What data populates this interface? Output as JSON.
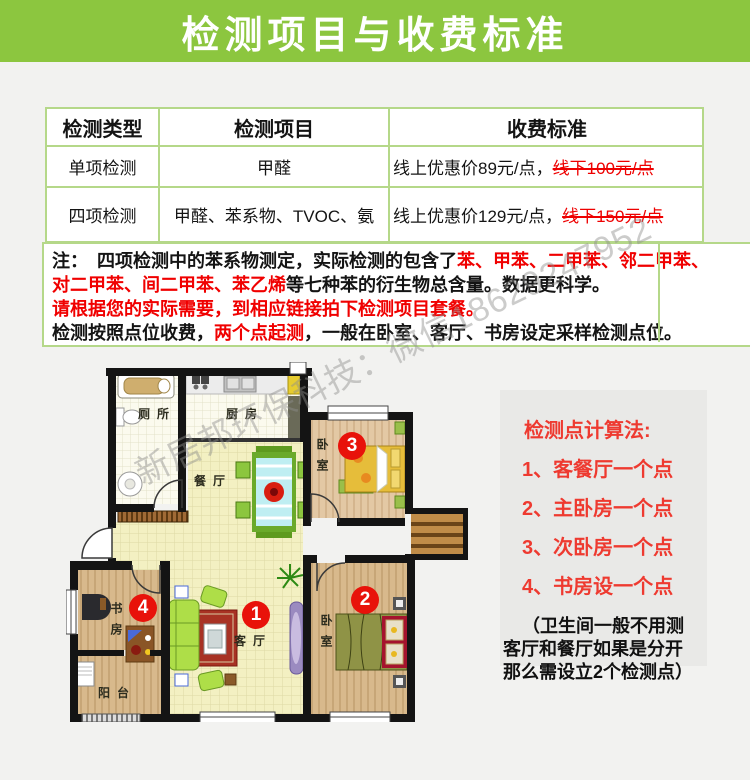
{
  "colors": {
    "header_green": "#8cc63f",
    "table_border_green": "#b5d889",
    "red_text": "#f00000",
    "panel_red": "#ee3a30",
    "marker_red": "#e8120a",
    "page_bg": "#f2f2f0",
    "panel_bg": "#e9e9e7"
  },
  "header": {
    "title": "检测项目与收费标准"
  },
  "table": {
    "headers": [
      "检测类型",
      "检测项目",
      "收费标准"
    ],
    "rows": [
      {
        "type": "单项检测",
        "items": "甲醛",
        "price_online": "线上优惠价89元/点，",
        "price_offline_struck": "线下100元/点"
      },
      {
        "type": "四项检测",
        "items": "甲醛、苯系物、TVOC、氨",
        "price_online": "线上优惠价129元/点，",
        "price_offline_struck": "线下150元/点"
      }
    ]
  },
  "note": {
    "l1a": "注：　四项检测中的苯系物测定，实际检测的包含了",
    "l1b": "苯、甲苯、二甲苯、邻二甲苯、",
    "l2a": "对二甲苯、间二甲苯、苯乙烯",
    "l2b": "等七种苯的衍生物总含量。数据更科学。",
    "l3": "请根据您的实际需要，到相应链接拍下检测项目套餐。",
    "l4a": "检测按照点位收费，",
    "l4b": "两个点起测",
    "l4c": "，一般在卧室、客厅、书房设定采样检测点位。"
  },
  "watermark": "新居邦环保科技：微信18629247952",
  "panel": {
    "title": "检测点计算法:",
    "items": [
      "1、客餐厅一个点",
      "2、主卧房一个点",
      "3、次卧房一个点",
      "4、书房设一个点"
    ],
    "note_line1": "（卫生间一般不用测",
    "note_line2": "客厅和餐厅如果是分开",
    "note_line3": "那么需设立2个检测点）"
  },
  "floorplan": {
    "labels": {
      "toilet": "厕所",
      "kitchen": "厨房",
      "dining": "餐厅",
      "living": "客厅",
      "bedroom_top": "卧室",
      "bedroom_right": "卧室",
      "study": "书房",
      "balcony": "阳台"
    },
    "markers": [
      "1",
      "2",
      "3",
      "4"
    ]
  }
}
